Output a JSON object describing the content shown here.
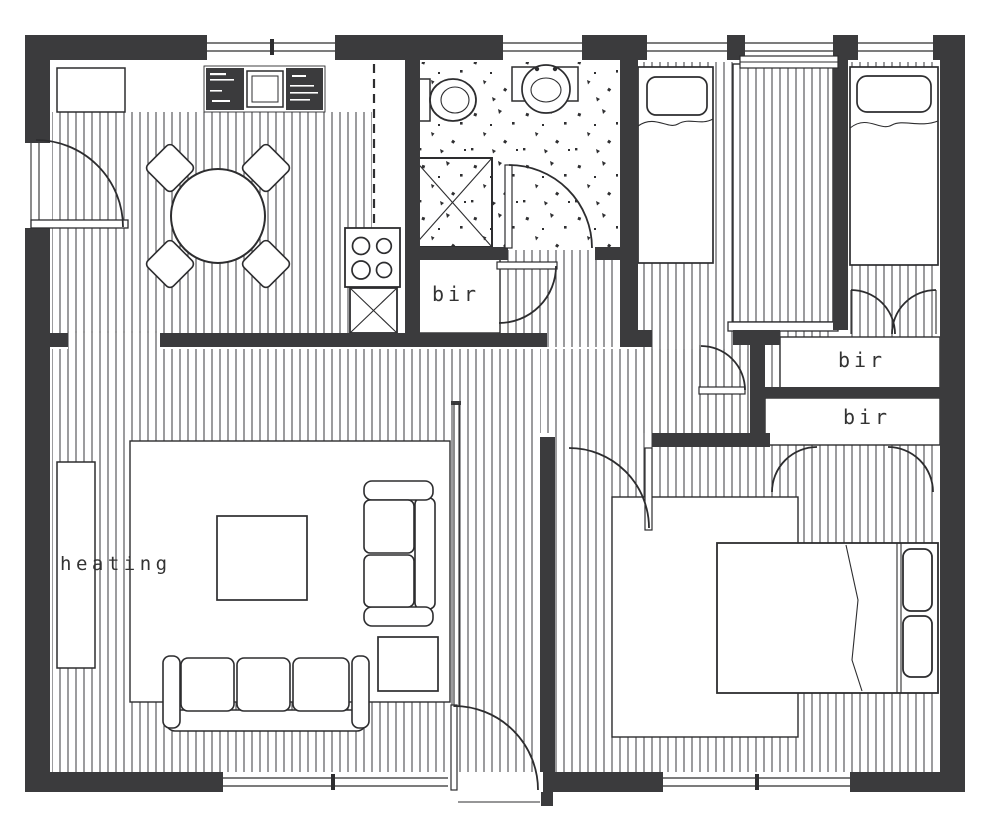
{
  "plan": {
    "labels": {
      "closet_hall": "bir",
      "closet_bedroom3": "bir",
      "closet_master": "bir",
      "heating": "heating"
    },
    "colors": {
      "wall": "#3b3b3d",
      "ink": "#2d2d2f",
      "hatch_line": "#4b4b4d",
      "paper": "#ffffff"
    }
  }
}
